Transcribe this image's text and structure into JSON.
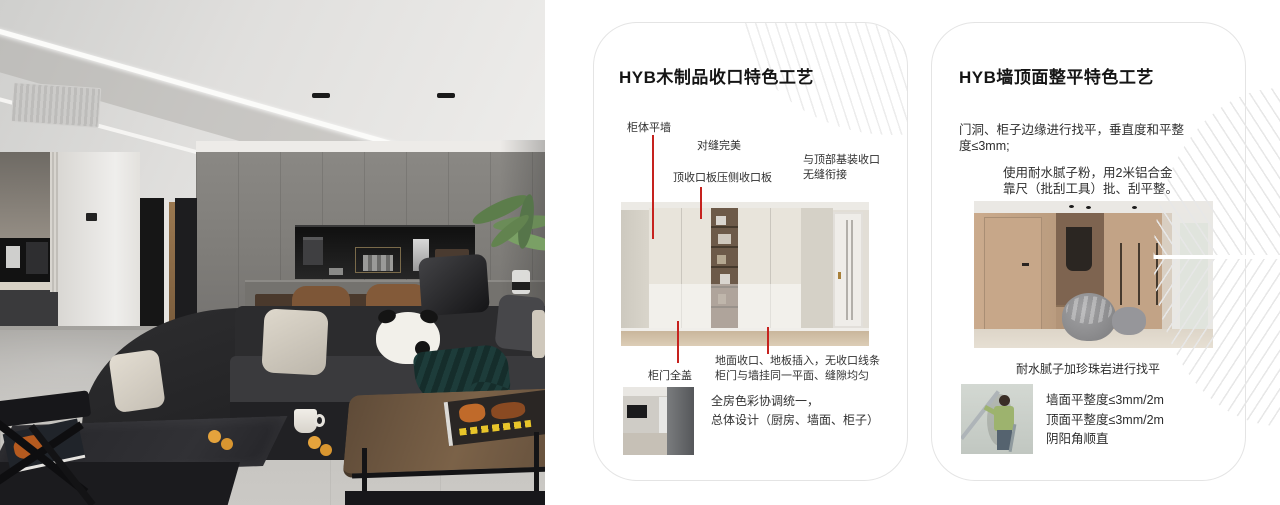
{
  "cards": {
    "card1": {
      "title": "HYB木制品收口特色工艺",
      "labels": {
        "cabinet_flush_wall": "柜体平墙",
        "perfect_seam": "对缝完美",
        "top_board": "顶收口板压侧收口板",
        "top_joint_line1": "与顶部基装收口",
        "top_joint_line2": "无缝衔接",
        "full_cover_door": "柜门全盖"
      },
      "floor_note_line1": "地面收口、地板插入，无收口线条",
      "floor_note_line2": "柜门与墙挂同一平面、缝隙均匀",
      "color_note_line1": "全房色彩协调统一，",
      "color_note_line2": "总体设计（厨房、墙面、柜子）"
    },
    "card2": {
      "title": "HYB墙顶面整平特色工艺",
      "para1_line1": "门洞、柜子边缘进行找平，垂直度和平整",
      "para1_line2": "度≤3mm;",
      "para2_line1": "使用耐水腻子粉，用2米铝合金",
      "para2_line2": "靠尺（批刮工具）批、刮平整。",
      "image_caption": "耐水腻子加珍珠岩进行找平",
      "spec_line1": "墙面平整度≤3mm/2m",
      "spec_line2": "顶面平整度≤3mm/2m",
      "spec_line3": "阴阳角顺直"
    }
  },
  "colors": {
    "annotation_red": "#c6221e",
    "card_border": "#e4e4e4",
    "decor_line": "#e8e8e8",
    "background": "#ffffff"
  }
}
